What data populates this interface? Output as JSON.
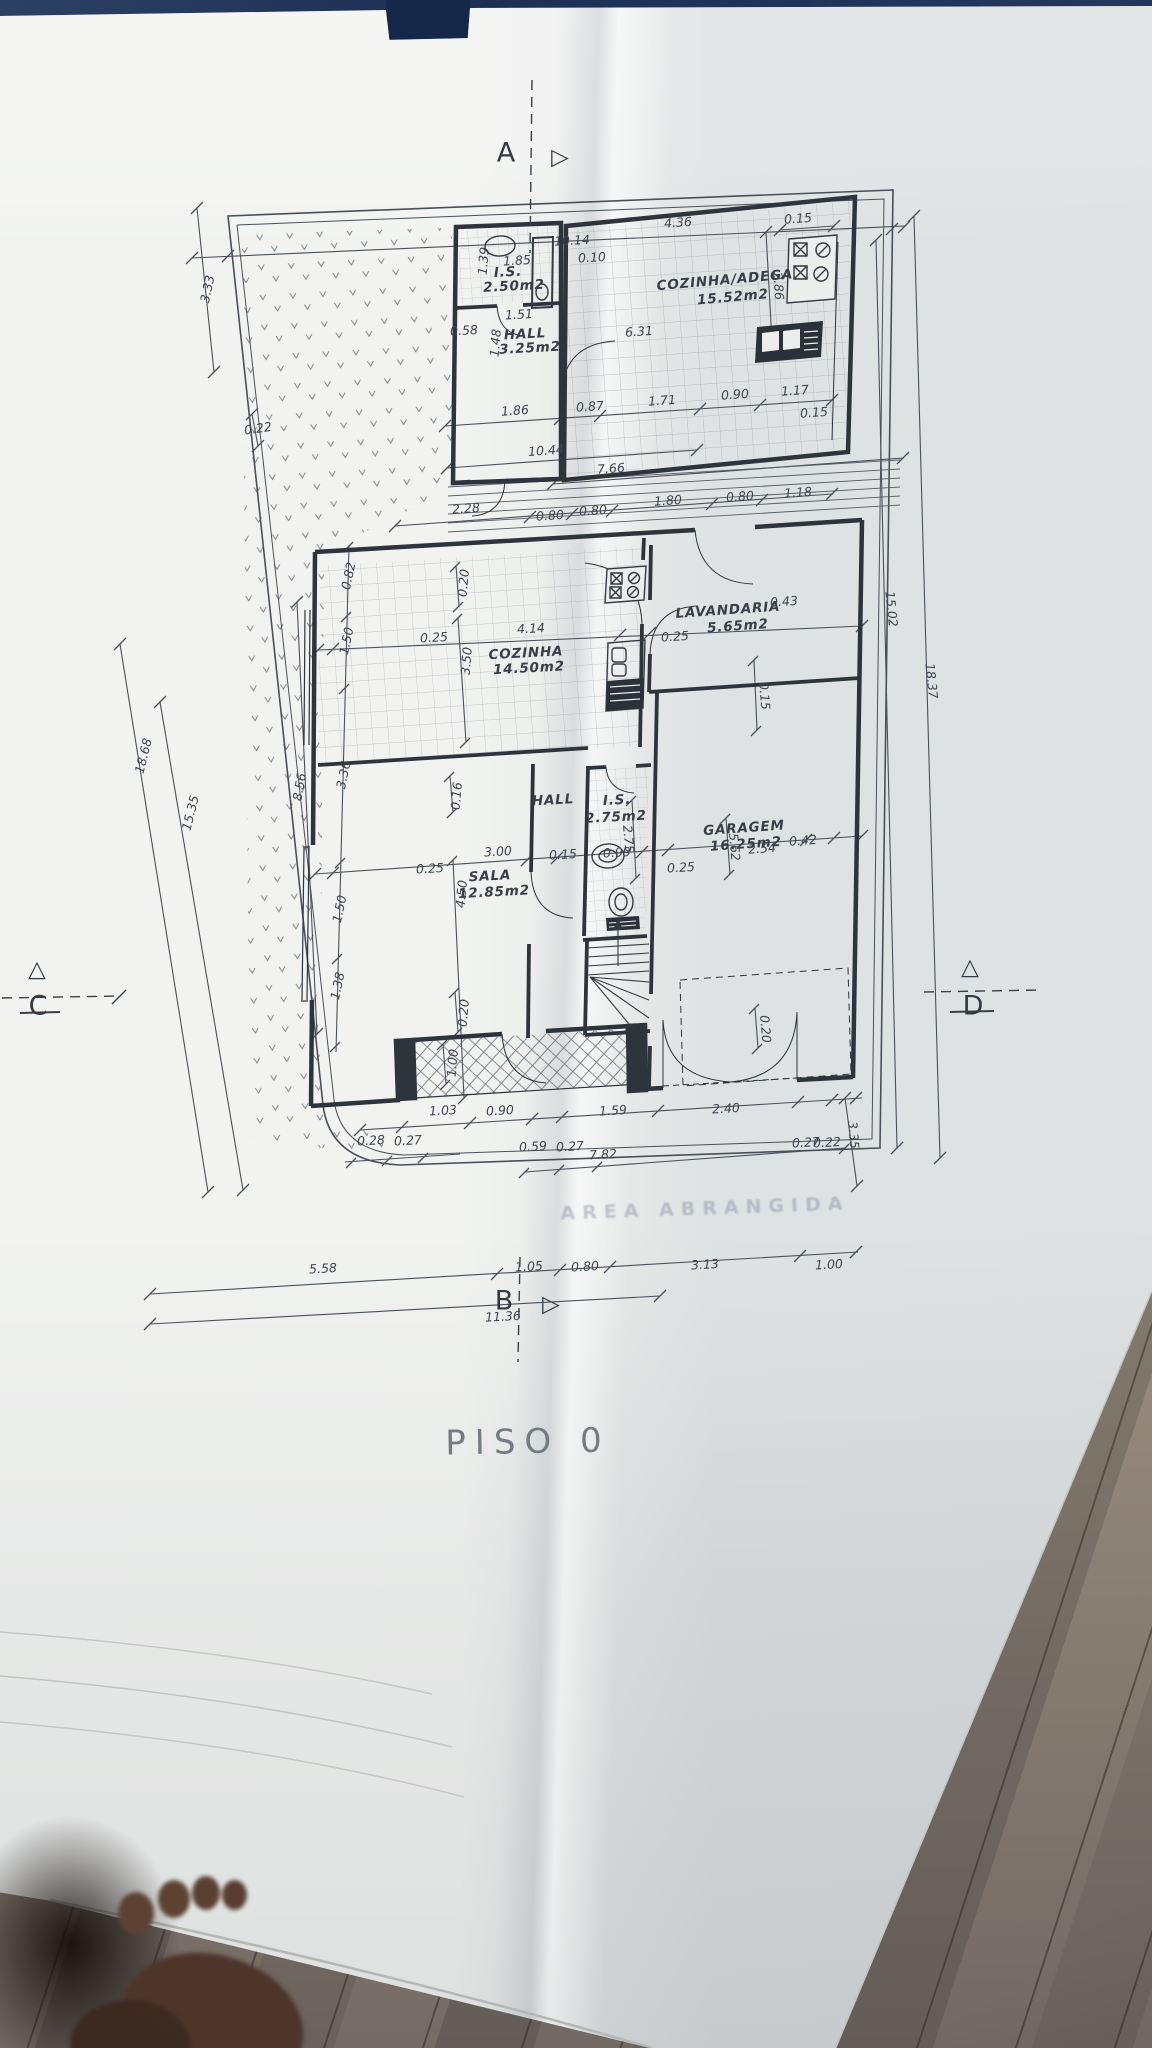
{
  "title": "PISO 0",
  "ghost_text": "AREA ABRANGIDA",
  "colors": {
    "paper": "#eceeec",
    "ink": "#3e4450",
    "wall": "#2e343c",
    "blue_strip": "#1d2f54",
    "wood": "#8f8478"
  },
  "labels": [
    {
      "t": "10.14",
      "x": 572,
      "y": 241,
      "r": -3
    },
    {
      "t": "1.85",
      "x": 517,
      "y": 261,
      "r": -3
    },
    {
      "t": "1.39",
      "x": 484,
      "y": 261,
      "r": -85
    },
    {
      "t": "I.S.",
      "x": 508,
      "y": 273,
      "r": -3,
      "c": "room"
    },
    {
      "t": "2.50m2",
      "x": 514,
      "y": 287,
      "r": -3,
      "c": "room"
    },
    {
      "t": "0.10",
      "x": 592,
      "y": 258,
      "r": -3
    },
    {
      "t": "1.51",
      "x": 519,
      "y": 315,
      "r": -3
    },
    {
      "t": "1.48",
      "x": 496,
      "y": 343,
      "r": -85
    },
    {
      "t": "0.58",
      "x": 464,
      "y": 331,
      "r": -3
    },
    {
      "t": "HALL",
      "x": 525,
      "y": 335,
      "r": -3,
      "c": "room"
    },
    {
      "t": "3.25m2",
      "x": 530,
      "y": 349,
      "r": -3,
      "c": "room"
    },
    {
      "t": "4.36",
      "x": 678,
      "y": 223,
      "r": -4
    },
    {
      "t": "0.15",
      "x": 798,
      "y": 219,
      "r": -4
    },
    {
      "t": "2.86",
      "x": 778,
      "y": 286,
      "r": 86
    },
    {
      "t": "COZINHA/ADEGA",
      "x": 725,
      "y": 281,
      "r": -5,
      "c": "room"
    },
    {
      "t": "15.52m2",
      "x": 733,
      "y": 298,
      "r": -5,
      "c": "room"
    },
    {
      "t": "6.31",
      "x": 639,
      "y": 332,
      "r": -4
    },
    {
      "t": "1.86",
      "x": 515,
      "y": 411,
      "r": -4
    },
    {
      "t": "0.87",
      "x": 590,
      "y": 407,
      "r": -4
    },
    {
      "t": "1.71",
      "x": 662,
      "y": 401,
      "r": -4
    },
    {
      "t": "0.90",
      "x": 735,
      "y": 395,
      "r": -4
    },
    {
      "t": "1.17",
      "x": 795,
      "y": 391,
      "r": -4
    },
    {
      "t": "0.15",
      "x": 814,
      "y": 413,
      "r": -4
    },
    {
      "t": "10.44",
      "x": 546,
      "y": 451,
      "r": -4
    },
    {
      "t": "7.66",
      "x": 611,
      "y": 469,
      "r": -4
    },
    {
      "t": "2.28",
      "x": 466,
      "y": 509,
      "r": -4
    },
    {
      "t": "0.80",
      "x": 550,
      "y": 516,
      "r": -4
    },
    {
      "t": "0.80",
      "x": 593,
      "y": 511,
      "r": -4
    },
    {
      "t": "1.80",
      "x": 668,
      "y": 501,
      "r": -4
    },
    {
      "t": "0.80",
      "x": 740,
      "y": 497,
      "r": -4
    },
    {
      "t": "1.18",
      "x": 798,
      "y": 493,
      "r": -4
    },
    {
      "t": "3.33",
      "x": 208,
      "y": 289,
      "r": -78
    },
    {
      "t": "0.22",
      "x": 258,
      "y": 429,
      "r": -8
    },
    {
      "t": "18.68",
      "x": 144,
      "y": 756,
      "r": -76
    },
    {
      "t": "15.35",
      "x": 191,
      "y": 813,
      "r": -76
    },
    {
      "t": "8.56",
      "x": 300,
      "y": 787,
      "r": -80
    },
    {
      "t": "0.82",
      "x": 349,
      "y": 576,
      "r": -78
    },
    {
      "t": "1.50",
      "x": 347,
      "y": 641,
      "r": -78
    },
    {
      "t": "3.36",
      "x": 344,
      "y": 775,
      "r": -78
    },
    {
      "t": "1.50",
      "x": 340,
      "y": 909,
      "r": -78
    },
    {
      "t": "1.38",
      "x": 338,
      "y": 986,
      "r": -78
    },
    {
      "t": "0.20",
      "x": 464,
      "y": 583,
      "r": -85
    },
    {
      "t": "3.50",
      "x": 467,
      "y": 661,
      "r": -85
    },
    {
      "t": "4.14",
      "x": 531,
      "y": 629,
      "r": -3
    },
    {
      "t": "0.25",
      "x": 434,
      "y": 638,
      "r": -3
    },
    {
      "t": "COZINHA",
      "x": 526,
      "y": 654,
      "r": -3,
      "c": "room"
    },
    {
      "t": "14.50m2",
      "x": 529,
      "y": 669,
      "r": -3,
      "c": "room"
    },
    {
      "t": "0.25",
      "x": 675,
      "y": 637,
      "r": -3
    },
    {
      "t": "LAVANDARIA",
      "x": 728,
      "y": 611,
      "r": -4,
      "c": "room"
    },
    {
      "t": "5.65m2",
      "x": 738,
      "y": 627,
      "r": -4,
      "c": "room"
    },
    {
      "t": "0.43",
      "x": 784,
      "y": 602,
      "r": -4
    },
    {
      "t": "15.02",
      "x": 891,
      "y": 609,
      "r": 84
    },
    {
      "t": "18.37",
      "x": 931,
      "y": 681,
      "r": 84
    },
    {
      "t": "0.15",
      "x": 764,
      "y": 696,
      "r": 85
    },
    {
      "t": "HALL",
      "x": 553,
      "y": 801,
      "r": -3,
      "c": "room"
    },
    {
      "t": "I.S.",
      "x": 617,
      "y": 801,
      "r": -3,
      "c": "room"
    },
    {
      "t": "2.75m2",
      "x": 616,
      "y": 818,
      "r": -3,
      "c": "room"
    },
    {
      "t": "2.75",
      "x": 628,
      "y": 839,
      "r": 85
    },
    {
      "t": "0.15",
      "x": 563,
      "y": 855,
      "r": -3
    },
    {
      "t": "0.99",
      "x": 617,
      "y": 853,
      "r": -3
    },
    {
      "t": "0.25",
      "x": 681,
      "y": 868,
      "r": -3
    },
    {
      "t": "0.25",
      "x": 430,
      "y": 869,
      "r": -3
    },
    {
      "t": "3.00",
      "x": 498,
      "y": 852,
      "r": -3
    },
    {
      "t": "SALA",
      "x": 490,
      "y": 877,
      "r": -3,
      "c": "room"
    },
    {
      "t": "12.85m2",
      "x": 494,
      "y": 893,
      "r": -3,
      "c": "room"
    },
    {
      "t": "4.50",
      "x": 462,
      "y": 894,
      "r": -85
    },
    {
      "t": "0.16",
      "x": 457,
      "y": 796,
      "r": -85
    },
    {
      "t": "0.20",
      "x": 464,
      "y": 1013,
      "r": -85
    },
    {
      "t": "GARAGEM",
      "x": 744,
      "y": 829,
      "r": -4,
      "c": "room"
    },
    {
      "t": "16.25m2",
      "x": 746,
      "y": 845,
      "r": -4,
      "c": "room"
    },
    {
      "t": "2.54",
      "x": 762,
      "y": 849,
      "r": -4
    },
    {
      "t": "5.62",
      "x": 734,
      "y": 847,
      "r": 85
    },
    {
      "t": "0.42",
      "x": 803,
      "y": 841,
      "r": -4
    },
    {
      "t": "0.20",
      "x": 765,
      "y": 1029,
      "r": 85
    },
    {
      "t": "1.00",
      "x": 453,
      "y": 1063,
      "r": -85
    },
    {
      "t": "1.03",
      "x": 443,
      "y": 1111,
      "r": -3
    },
    {
      "t": "0.90",
      "x": 500,
      "y": 1111,
      "r": -3
    },
    {
      "t": "1.59",
      "x": 613,
      "y": 1111,
      "r": -3
    },
    {
      "t": "2.40",
      "x": 726,
      "y": 1109,
      "r": -3
    },
    {
      "t": "0.28",
      "x": 371,
      "y": 1141,
      "r": -3
    },
    {
      "t": "0.27",
      "x": 408,
      "y": 1141,
      "r": -3
    },
    {
      "t": "0.59",
      "x": 533,
      "y": 1147,
      "r": -3
    },
    {
      "t": "0.27",
      "x": 570,
      "y": 1147,
      "r": -3
    },
    {
      "t": "7.82",
      "x": 603,
      "y": 1155,
      "r": -3
    },
    {
      "t": "0.27",
      "x": 806,
      "y": 1143,
      "r": -3
    },
    {
      "t": "0.22",
      "x": 827,
      "y": 1143,
      "r": -3
    },
    {
      "t": "3.35",
      "x": 853,
      "y": 1135,
      "r": 85
    },
    {
      "t": "5.58",
      "x": 323,
      "y": 1269,
      "r": -3
    },
    {
      "t": "1.05",
      "x": 529,
      "y": 1267,
      "r": -3
    },
    {
      "t": "0.80",
      "x": 585,
      "y": 1267,
      "r": -3
    },
    {
      "t": "3.13",
      "x": 705,
      "y": 1265,
      "r": -3
    },
    {
      "t": "1.00",
      "x": 829,
      "y": 1265,
      "r": -3
    },
    {
      "t": "11.36",
      "x": 503,
      "y": 1317,
      "r": -3
    },
    {
      "t": "A",
      "x": 506,
      "y": 153,
      "r": 0,
      "c": "marker"
    },
    {
      "t": "▷",
      "x": 560,
      "y": 158,
      "r": 0,
      "c": "glyph"
    },
    {
      "t": "B",
      "x": 504,
      "y": 1301,
      "r": 0,
      "c": "marker"
    },
    {
      "t": "▷",
      "x": 551,
      "y": 1305,
      "r": 0,
      "c": "glyph"
    },
    {
      "t": "C",
      "x": 38,
      "y": 1006,
      "r": 0,
      "c": "marker"
    },
    {
      "t": "△",
      "x": 37,
      "y": 970,
      "r": 0,
      "c": "glyph"
    },
    {
      "t": "D",
      "x": 973,
      "y": 1006,
      "r": 0,
      "c": "marker"
    },
    {
      "t": "△",
      "x": 970,
      "y": 968,
      "r": 0,
      "c": "glyph"
    }
  ]
}
